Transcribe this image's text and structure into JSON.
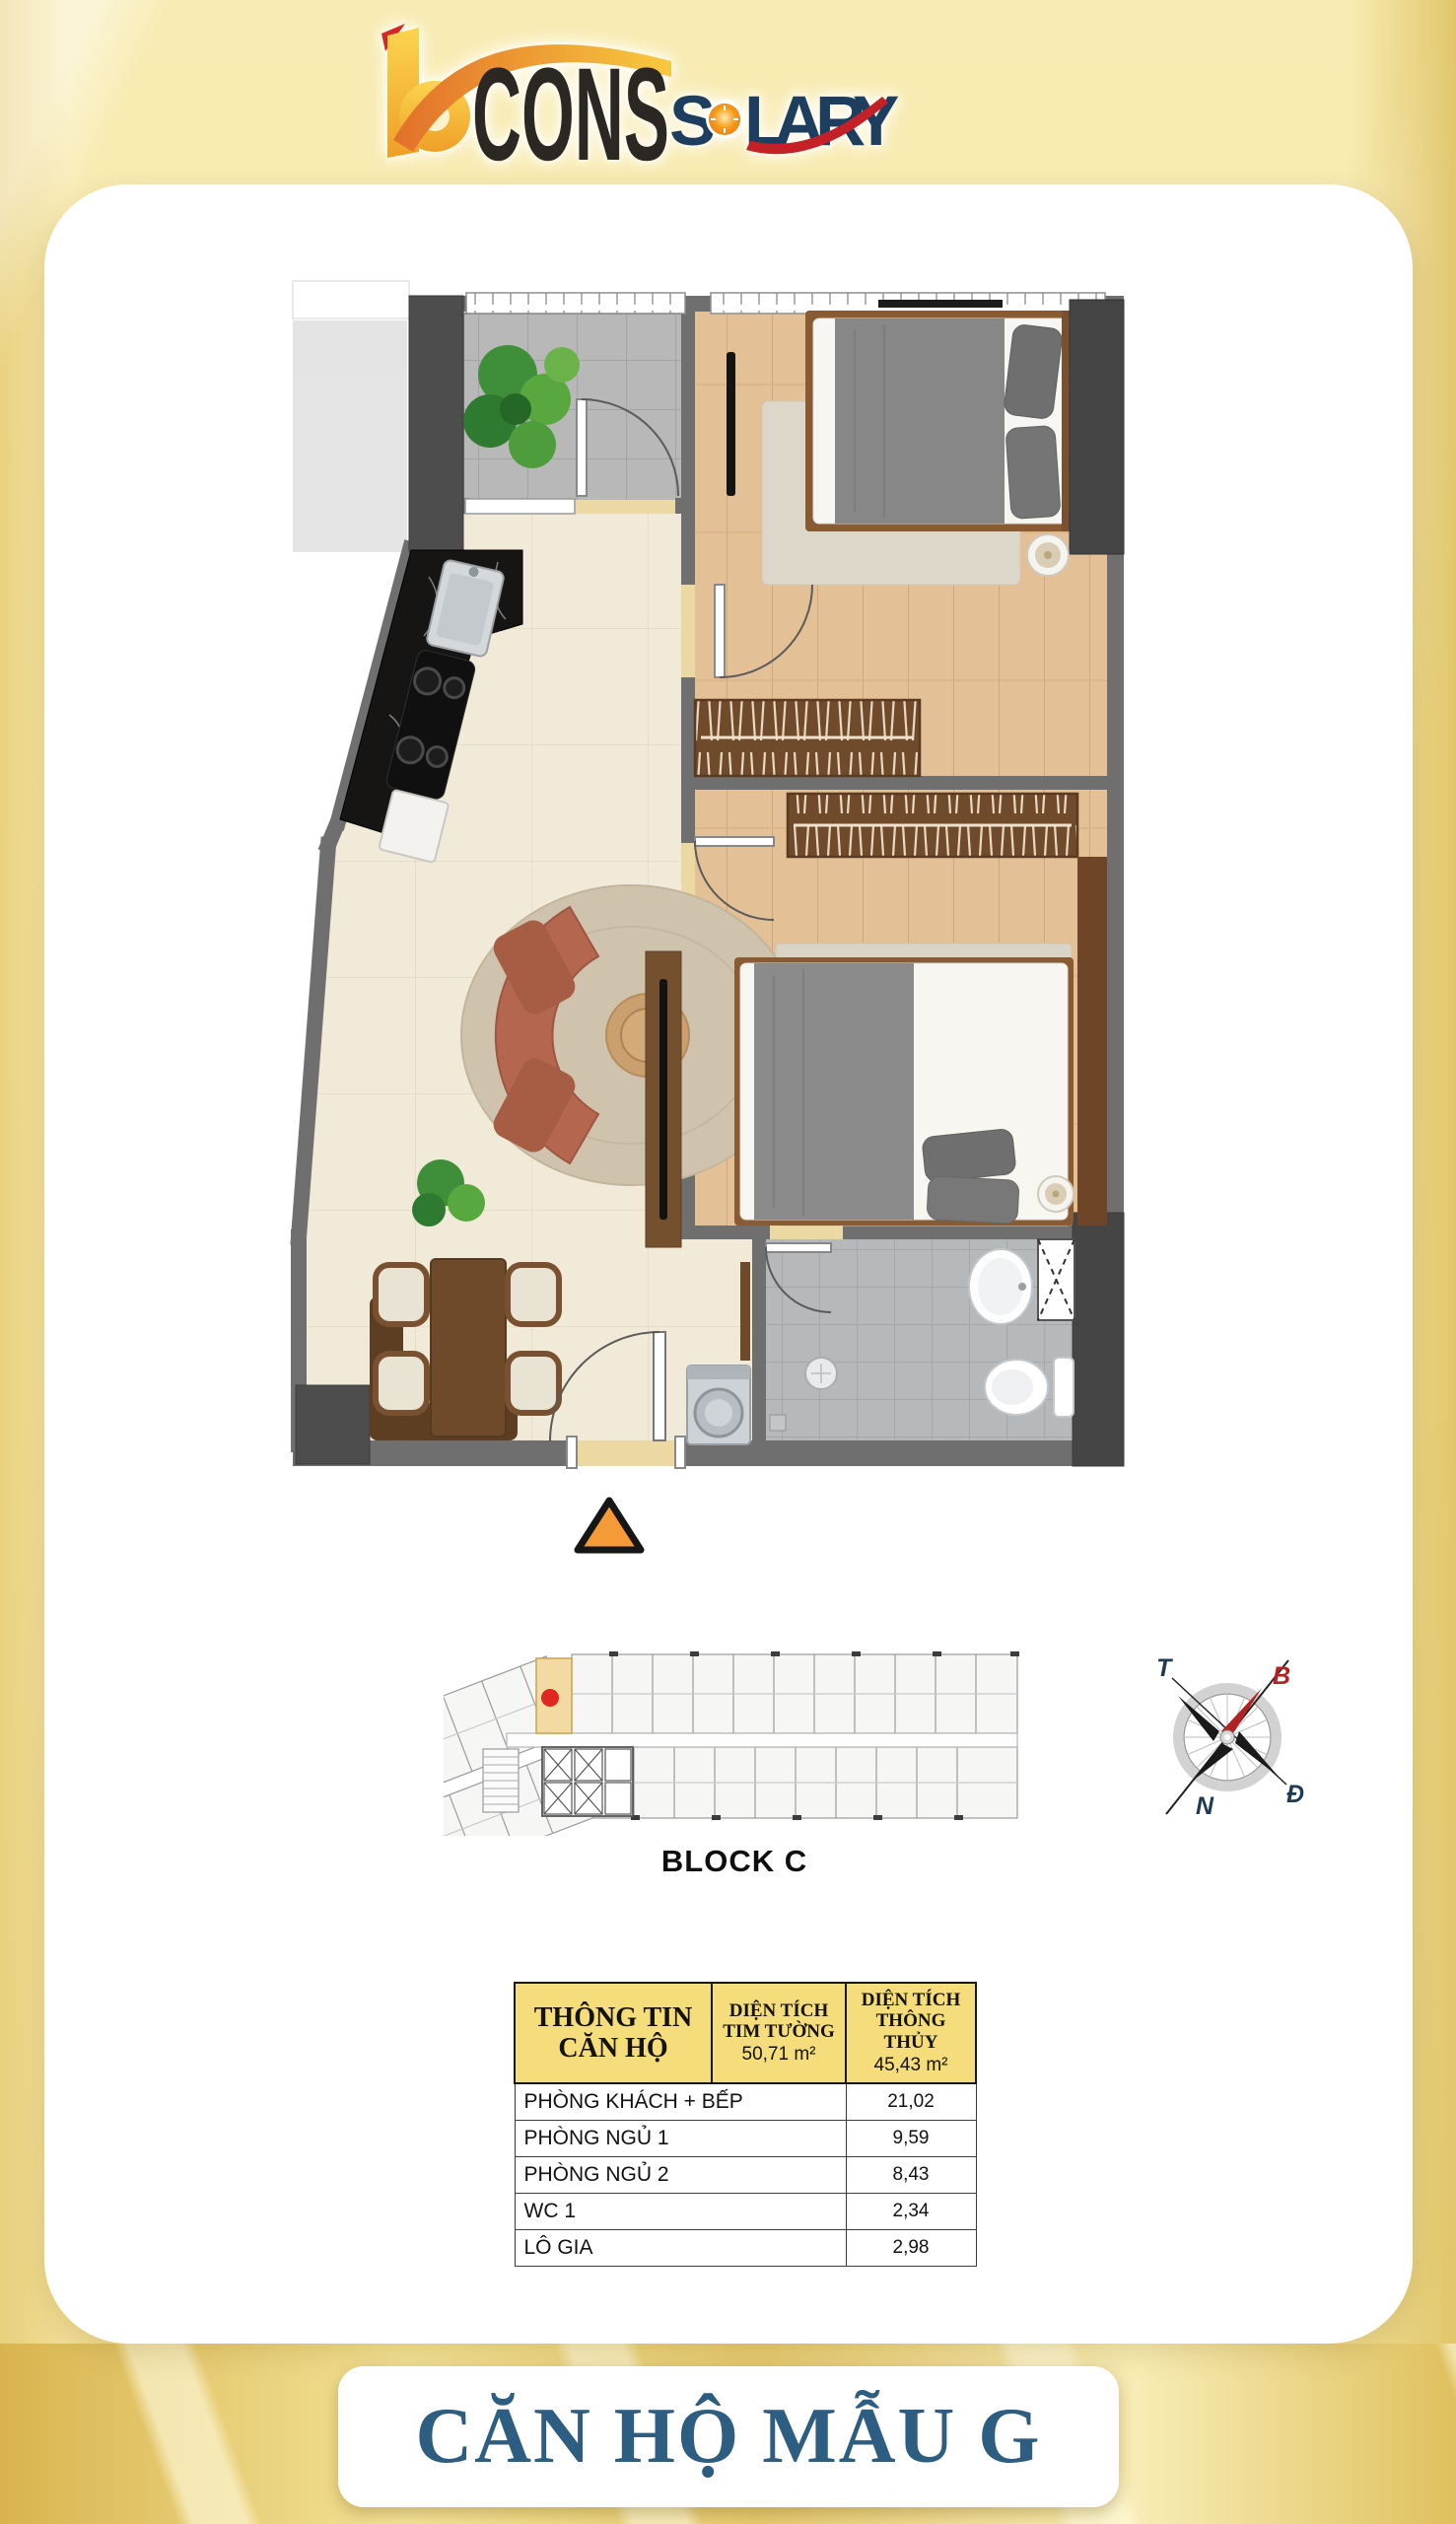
{
  "logo": {
    "brand": "CONS",
    "product": "SOLARY",
    "product_letters": [
      "S",
      "O",
      "L",
      "A",
      "R",
      "Y"
    ]
  },
  "block": {
    "label": "BLOCK C",
    "highlight_color": "#f3d9a2",
    "marker_color": "#e02621"
  },
  "compass": {
    "north": "B",
    "east": "Đ",
    "south": "N",
    "west": "T",
    "north_color": "#b51f1f",
    "label_color": "#1f3a55"
  },
  "info_table": {
    "header": {
      "col1": "THÔNG TIN CĂN HỘ",
      "col2_title": "DIỆN TÍCH TIM TƯỜNG",
      "col2_value": "50,71 m²",
      "col3_title": "DIỆN TÍCH THÔNG THỦY",
      "col3_value": "45,43 m²"
    },
    "rows": [
      {
        "label": "PHÒNG KHÁCH + BẾP",
        "value": "21,02"
      },
      {
        "label": "PHÒNG NGỦ 1",
        "value": "9,59"
      },
      {
        "label": "PHÒNG NGỦ 2",
        "value": "8,43"
      },
      {
        "label": "WC 1",
        "value": "2,34"
      },
      {
        "label": "LÔ GIA",
        "value": "2,98"
      }
    ]
  },
  "footer": {
    "title": "CĂN HỘ MẪU G"
  },
  "colors": {
    "background_gold": "#f6e8a8",
    "card_white": "#ffffff",
    "table_header_yellow": "#f5dd7b",
    "title_blue": "#2d5d80",
    "entrance_marker_orange": "#f49a36",
    "logo_black": "#2b2723",
    "logo_navy": "#1d3e5f",
    "logo_gold": "#f5b733",
    "logo_orange": "#e2702a"
  }
}
